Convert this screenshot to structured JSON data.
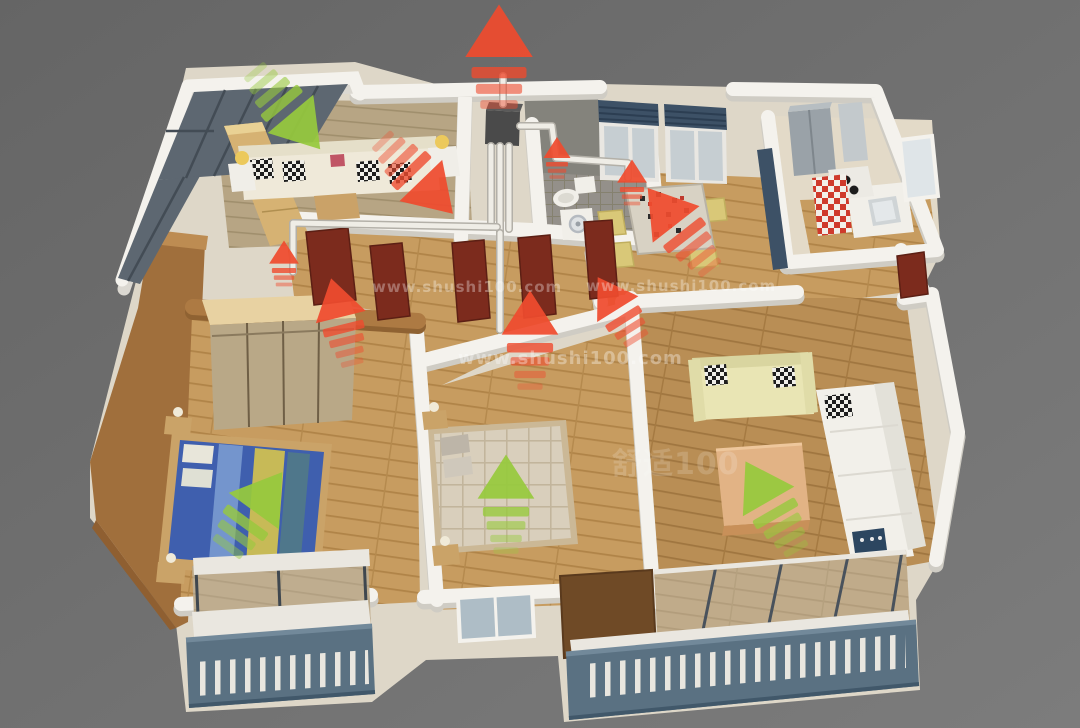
{
  "colors": {
    "exhaust_arrow": "#ef4b2e",
    "fresh_arrow": "#97c93d",
    "background": "#6c6c6c",
    "wall": "#f4f2ed",
    "wood_floor": "#c79c60",
    "brown_wall": "#a06f3c",
    "balcony_railing": "#5a7182",
    "vent_unit": "#4a4a4a",
    "duct": "#efede6",
    "watermark": "#ffffff"
  },
  "scene": {
    "watermarks": [
      {
        "name": "watermark-url-1",
        "text": "www.shushi100.com",
        "x": 372,
        "y": 292,
        "size": 15,
        "opacity": 0.32
      },
      {
        "name": "watermark-url-2",
        "text": "www.shushi100.com",
        "x": 586,
        "y": 291,
        "size": 15,
        "opacity": 0.32
      },
      {
        "name": "watermark-url-3",
        "text": "www.shushi100.com",
        "x": 458,
        "y": 364,
        "size": 18,
        "opacity": 0.34
      },
      {
        "name": "watermark-logo",
        "text": "舒适100",
        "x": 612,
        "y": 474,
        "size": 30,
        "opacity": 0.16
      }
    ],
    "ducts": [
      {
        "name": "duct-roof-riser",
        "points": [
          [
            503,
            76
          ],
          [
            503,
            104
          ]
        ]
      },
      {
        "name": "duct-unit-drop-1",
        "points": [
          [
            491,
            146
          ],
          [
            491,
            227
          ]
        ]
      },
      {
        "name": "duct-unit-drop-2",
        "points": [
          [
            500,
            146
          ],
          [
            500,
            233
          ]
        ]
      },
      {
        "name": "duct-unit-drop-3",
        "points": [
          [
            509,
            146
          ],
          [
            509,
            229
          ]
        ]
      },
      {
        "name": "duct-east-run",
        "points": [
          [
            520,
            126
          ],
          [
            552,
            126
          ],
          [
            556,
            158
          ],
          [
            628,
            163
          ],
          [
            628,
            178
          ]
        ]
      },
      {
        "name": "duct-west-run",
        "points": [
          [
            497,
            227
          ],
          [
            293,
            223
          ],
          [
            293,
            272
          ]
        ]
      },
      {
        "name": "duct-south-run",
        "points": [
          [
            500,
            233
          ],
          [
            500,
            330
          ]
        ]
      }
    ],
    "arrows": [
      {
        "name": "exhaust-outlet-main",
        "kind": "exhaust",
        "x": 499,
        "y": 42,
        "rot": 0,
        "scale": 1.25,
        "dashes": 3
      },
      {
        "name": "exhaust-study",
        "kind": "exhaust",
        "x": 430,
        "y": 190,
        "rot": 136,
        "scale": 1.1,
        "dashes": 4
      },
      {
        "name": "exhaust-master-door",
        "kind": "exhaust",
        "x": 338,
        "y": 306,
        "rot": -14,
        "scale": 0.95,
        "dashes": 4
      },
      {
        "name": "exhaust-bedroom2-wall",
        "kind": "exhaust",
        "x": 530,
        "y": 322,
        "rot": 0,
        "scale": 1.05,
        "dashes": 4
      },
      {
        "name": "exhaust-entry-hall",
        "kind": "exhaust",
        "x": 612,
        "y": 300,
        "rot": -32,
        "scale": 0.9,
        "dashes": 3
      },
      {
        "name": "exhaust-dining-large",
        "kind": "exhaust",
        "x": 668,
        "y": 214,
        "rot": -38,
        "scale": 1.1,
        "dashes": 4
      },
      {
        "name": "exhaust-dining-duct",
        "kind": "exhaust",
        "x": 632,
        "y": 176,
        "rot": 0,
        "scale": 0.55,
        "dashes": 3
      },
      {
        "name": "exhaust-bathroom",
        "kind": "exhaust",
        "x": 557,
        "y": 152,
        "rot": 0,
        "scale": 0.5,
        "dashes": 3
      },
      {
        "name": "exhaust-hallway-duct",
        "kind": "exhaust",
        "x": 284,
        "y": 257,
        "rot": 0,
        "scale": 0.55,
        "dashes": 3
      },
      {
        "name": "fresh-study-inlet",
        "kind": "fresh",
        "x": 299,
        "y": 124,
        "rot": 140,
        "scale": 1.1,
        "dashes": 4
      },
      {
        "name": "fresh-master-bedroom",
        "kind": "fresh",
        "x": 262,
        "y": 500,
        "rot": 36,
        "scale": 1.15,
        "dashes": 3
      },
      {
        "name": "fresh-bedroom2",
        "kind": "fresh",
        "x": 506,
        "y": 486,
        "rot": 0,
        "scale": 1.05,
        "dashes": 4
      },
      {
        "name": "fresh-living-room",
        "kind": "fresh",
        "x": 762,
        "y": 490,
        "rot": -30,
        "scale": 1.1,
        "dashes": 4
      }
    ]
  }
}
